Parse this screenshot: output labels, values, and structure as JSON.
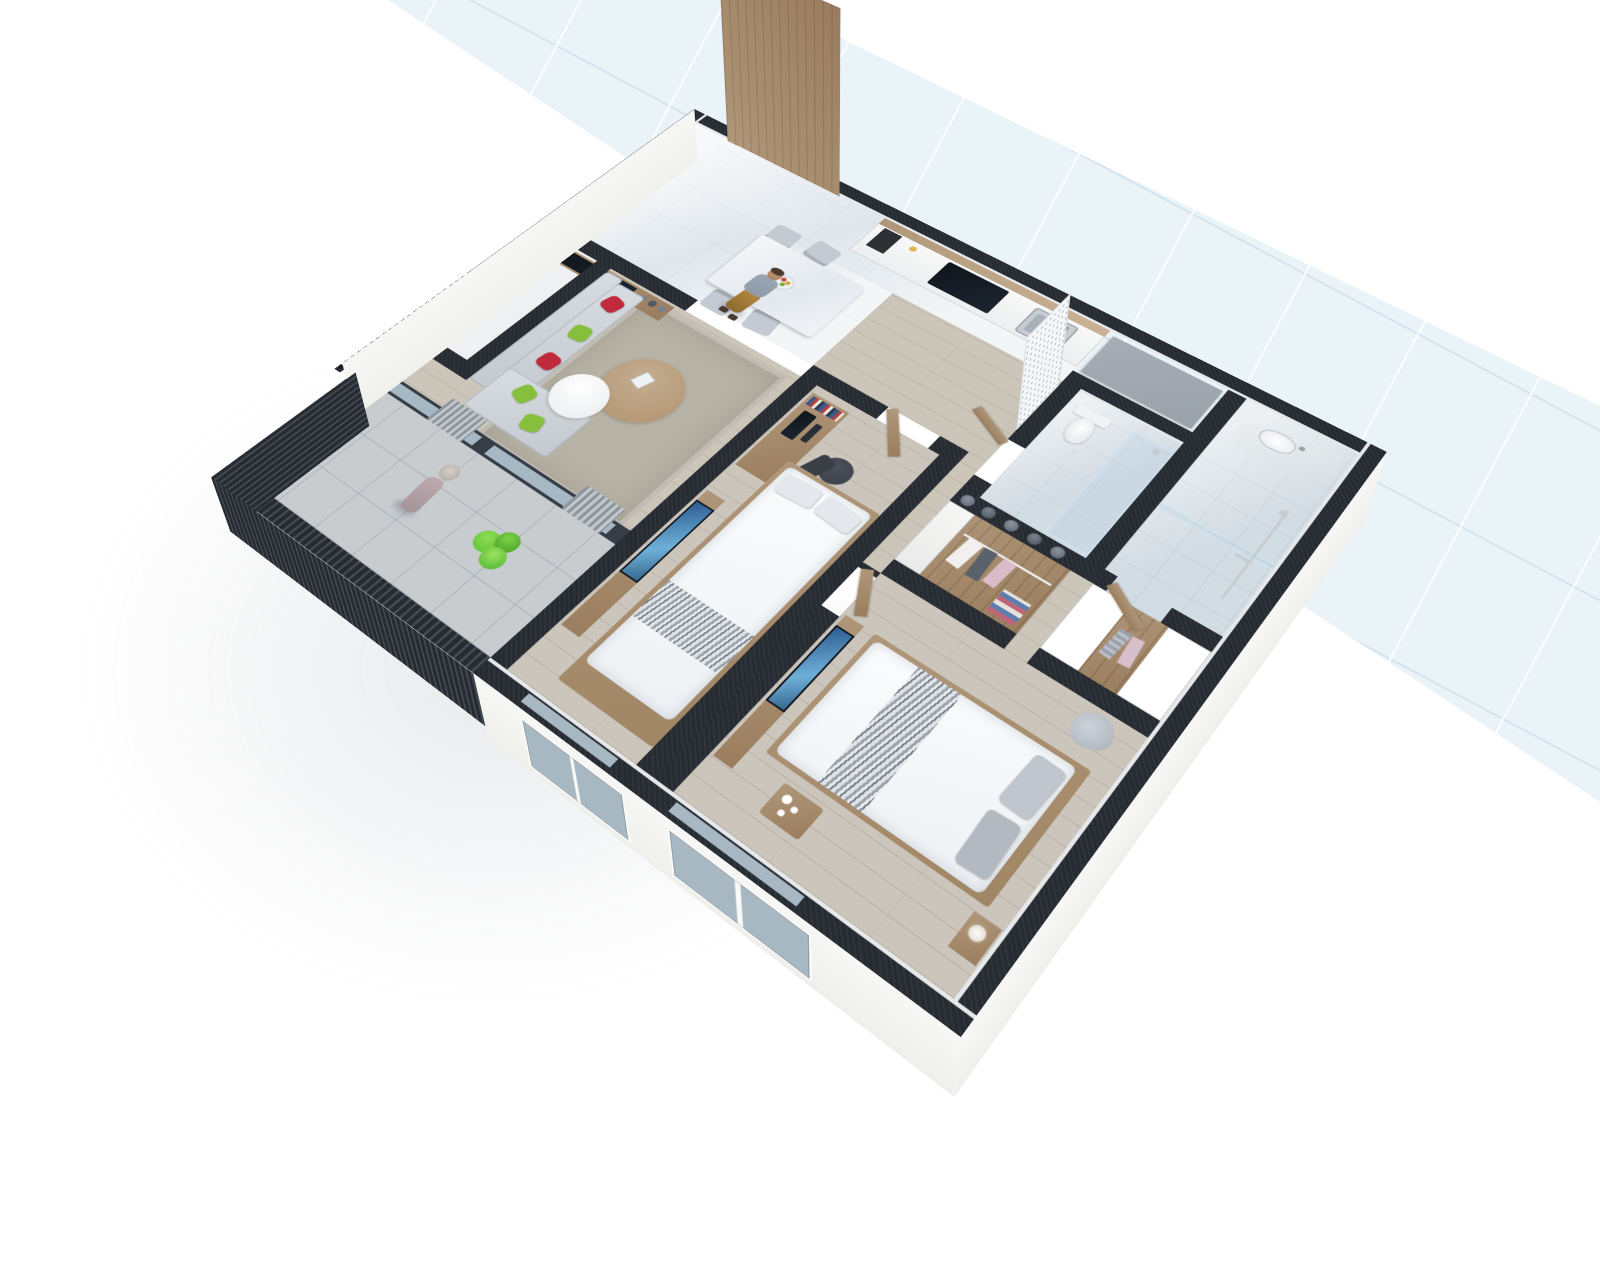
{
  "scene": {
    "type": "3d-isometric-apartment-floor-plan-render",
    "description": "Cutaway dollhouse view of a two-bedroom apartment on a white background, rotated about 38 degrees, with a light-blue tiled building corridor running diagonally behind it",
    "background": "#ffffff"
  },
  "palette": {
    "wall": "#262b31",
    "exterior": "#efefec",
    "floorWood": "#ccc5b9",
    "tile": "#eaeef1",
    "bathFloor": "#dbe2e7",
    "balconyTile": "#c8cccf",
    "corridorBlue": "#e9f3f8",
    "corridorCloud": "#cfe0ec",
    "woodDoor": "#9a7d5e",
    "woodMid": "#b0977a",
    "woodLight": "#c3ad92",
    "rug": "#b7b2a6",
    "sofa": "#d8dde1",
    "sofaShade": "#c3c9ce",
    "pillowRed": "#c02a3c",
    "pillowGreen": "#86bf3b",
    "glass": "#a7b8c2",
    "steel": "#c6ccd1",
    "duvet": "#eef1f4",
    "throw": "#9aa1a9",
    "chairGray": "#c3cad2",
    "officeChair": "#3a3f46",
    "slat": "#272c33",
    "slatLight": "#d7d9db",
    "plant": "#57c02f",
    "skin": "#c99d7e",
    "shirt": "#8d9aa7",
    "pants": "#b5883f",
    "ceilingSlab": "#99a1a9"
  },
  "rooms": [
    {
      "id": "entrance-hall",
      "floor": "glossy white tile",
      "features": [
        "tall wooden entrance door",
        "man standing"
      ]
    },
    {
      "id": "kitchen",
      "floor": "glossy white tile",
      "features": [
        "white cabinet run",
        "black cooktop",
        "steel sink",
        "wood open shelves",
        "gray dropped ceiling slab"
      ]
    },
    {
      "id": "dining-area",
      "floor": "glossy white tile",
      "features": [
        "white marble table",
        "four gray chairs",
        "fruit bowl"
      ]
    },
    {
      "id": "living-room",
      "floor": "light wood planks",
      "features": [
        "L-shaped gray sofa",
        "red pillows",
        "green pillows",
        "round wood coffee table",
        "round white side table",
        "TV console with TV and vases",
        "two botanical prints",
        "area rug",
        "gray curtains",
        "sliding glass door to balcony"
      ]
    },
    {
      "id": "balcony",
      "floor": "gray tile",
      "features": [
        "dark louvered railing",
        "woman with hat",
        "green plant"
      ]
    },
    {
      "id": "utility-niche",
      "floor": "white",
      "features": [
        "empty narrow room"
      ]
    },
    {
      "id": "ac-ledge",
      "floor": "louvered grille",
      "features": [
        "black louver slats outside west wall"
      ]
    },
    {
      "id": "wc-bathroom",
      "floor": "light gray tile",
      "features": [
        "toilet",
        "glass shower partition",
        "decorative perforated screen",
        "wood door"
      ]
    },
    {
      "id": "master-bathroom",
      "floor": "light gray tile",
      "features": [
        "vanity with basin",
        "chrome shower set",
        "glass partition",
        "wood door"
      ]
    },
    {
      "id": "wardrobe-corridor",
      "floor": "wood",
      "features": [
        "open wood wardrobe with hanging clothes",
        "white wardrobe doors",
        "round boxes on top"
      ]
    },
    {
      "id": "bedroom-1",
      "floor": "gray wood planks",
      "features": [
        "double bed with white duvet and patterned throw",
        "wood desk with monitor and books",
        "black office chair",
        "low TV bench with leaning TV",
        "wood door",
        "window"
      ]
    },
    {
      "id": "bedroom-2",
      "floor": "gray wood planks",
      "features": [
        "double bed with gray pillows",
        "low TV bench with leaning TV",
        "wardrobe row",
        "nightstand with lamp",
        "gray armchair",
        "small tea table with white cups",
        "window"
      ]
    }
  ],
  "people": [
    {
      "id": "man-standing-entrance",
      "clothing": "gray-blue t-shirt, tan trousers"
    },
    {
      "id": "woman-on-balcony",
      "clothing": "gray hat, mauve outfit"
    }
  ]
}
